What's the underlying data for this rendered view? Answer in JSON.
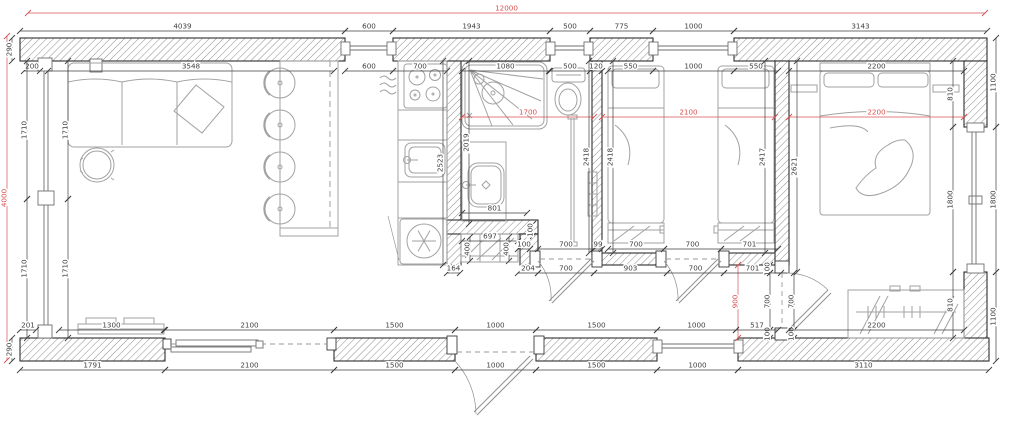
{
  "drawing": {
    "type_label": "floor-plan",
    "overall_width_mm": "12000",
    "overall_height_mm": "4000"
  },
  "colors": {
    "dim": "#3f3f3f",
    "red": "#d95050",
    "wall_stroke": "#2e2e2e",
    "hatch": "#8d8d8d",
    "furniture": "#a2a2a2"
  },
  "fixtures": [
    "sofa",
    "coffee-table",
    "bar-counter",
    "bar-stool",
    "cooktop",
    "kitchen-sink",
    "fridge",
    "shower",
    "toilet",
    "wash-basin",
    "towel-radiator",
    "hall-closet",
    "single-bed",
    "double-bed",
    "wardrobe",
    "tv-bench",
    "sliding-door",
    "entrance-door",
    "interior-door",
    "window"
  ],
  "dims": [
    {
      "x1": 28,
      "y1": 13,
      "x2": 985,
      "y2": 13,
      "t": "12000",
      "c": "red"
    },
    {
      "x1": 7,
      "y1": 36,
      "x2": 7,
      "y2": 360,
      "t": "4000",
      "c": "red"
    },
    {
      "x1": 462,
      "y1": 117,
      "x2": 594,
      "y2": 117,
      "t": "1700",
      "c": "red"
    },
    {
      "x1": 602,
      "y1": 117,
      "x2": 775,
      "y2": 117,
      "t": "2100",
      "c": "red"
    },
    {
      "x1": 789,
      "y1": 117,
      "x2": 964,
      "y2": 117,
      "t": "2200",
      "c": "red"
    },
    {
      "x1": 738,
      "y1": 265,
      "x2": 738,
      "y2": 338,
      "t": "900",
      "c": "red"
    },
    {
      "x1": 20,
      "y1": 31,
      "x2": 345,
      "y2": 31,
      "t": "4039"
    },
    {
      "x1": 345,
      "y1": 31,
      "x2": 393,
      "y2": 31,
      "t": "600"
    },
    {
      "x1": 393,
      "y1": 31,
      "x2": 550,
      "y2": 31,
      "t": "1943"
    },
    {
      "x1": 550,
      "y1": 31,
      "x2": 590,
      "y2": 31,
      "t": "500"
    },
    {
      "x1": 590,
      "y1": 31,
      "x2": 653,
      "y2": 31,
      "t": "775"
    },
    {
      "x1": 653,
      "y1": 31,
      "x2": 734,
      "y2": 31,
      "t": "1000"
    },
    {
      "x1": 734,
      "y1": 31,
      "x2": 987,
      "y2": 31,
      "t": "3143"
    },
    {
      "x1": 24,
      "y1": 71,
      "x2": 40,
      "y2": 71,
      "t": "200"
    },
    {
      "x1": 48,
      "y1": 71,
      "x2": 334,
      "y2": 71,
      "t": "3548"
    },
    {
      "x1": 345,
      "y1": 71,
      "x2": 393,
      "y2": 71,
      "t": "600"
    },
    {
      "x1": 393,
      "y1": 71,
      "x2": 447,
      "y2": 71,
      "t": "700"
    },
    {
      "x1": 462,
      "y1": 71,
      "x2": 549,
      "y2": 71,
      "t": "1080"
    },
    {
      "x1": 550,
      "y1": 71,
      "x2": 590,
      "y2": 71,
      "t": "500"
    },
    {
      "x1": 590,
      "y1": 71,
      "x2": 602,
      "y2": 71,
      "t": "120"
    },
    {
      "x1": 608,
      "y1": 71,
      "x2": 653,
      "y2": 71,
      "t": "550"
    },
    {
      "x1": 653,
      "y1": 71,
      "x2": 734,
      "y2": 71,
      "t": "1000"
    },
    {
      "x1": 734,
      "y1": 71,
      "x2": 778,
      "y2": 71,
      "t": "550"
    },
    {
      "x1": 789,
      "y1": 71,
      "x2": 964,
      "y2": 71,
      "t": "2200"
    },
    {
      "x1": 12,
      "y1": 38,
      "x2": 12,
      "y2": 61,
      "t": "290"
    },
    {
      "x1": 12,
      "y1": 338,
      "x2": 12,
      "y2": 361,
      "t": "290"
    },
    {
      "x1": 27,
      "y1": 61,
      "x2": 27,
      "y2": 199,
      "t": "1710"
    },
    {
      "x1": 27,
      "y1": 199,
      "x2": 27,
      "y2": 338,
      "t": "1710"
    },
    {
      "x1": 68,
      "y1": 61,
      "x2": 68,
      "y2": 199,
      "t": "1710"
    },
    {
      "x1": 68,
      "y1": 199,
      "x2": 68,
      "y2": 338,
      "t": "1710"
    },
    {
      "x1": 953,
      "y1": 61,
      "x2": 953,
      "y2": 127,
      "t": "810"
    },
    {
      "x1": 953,
      "y1": 127,
      "x2": 953,
      "y2": 272,
      "t": "1800"
    },
    {
      "x1": 953,
      "y1": 272,
      "x2": 953,
      "y2": 338,
      "t": "810"
    },
    {
      "x1": 996,
      "y1": 38,
      "x2": 996,
      "y2": 127,
      "t": "1100"
    },
    {
      "x1": 996,
      "y1": 127,
      "x2": 996,
      "y2": 272,
      "t": "1800"
    },
    {
      "x1": 996,
      "y1": 272,
      "x2": 996,
      "y2": 361,
      "t": "1100"
    },
    {
      "x1": 443,
      "y1": 61,
      "x2": 443,
      "y2": 265,
      "t": "2523"
    },
    {
      "x1": 469,
      "y1": 61,
      "x2": 469,
      "y2": 224,
      "t": "2019"
    },
    {
      "x1": 589,
      "y1": 61,
      "x2": 589,
      "y2": 253,
      "t": "2418"
    },
    {
      "x1": 613,
      "y1": 61,
      "x2": 613,
      "y2": 253,
      "t": "2418"
    },
    {
      "x1": 765,
      "y1": 61,
      "x2": 765,
      "y2": 253,
      "t": "2417"
    },
    {
      "x1": 797,
      "y1": 61,
      "x2": 797,
      "y2": 272,
      "t": "2621"
    },
    {
      "x1": 462,
      "y1": 213,
      "x2": 527,
      "y2": 213,
      "t": "801"
    },
    {
      "x1": 462,
      "y1": 241,
      "x2": 518,
      "y2": 241,
      "t": "697"
    },
    {
      "x1": 470,
      "y1": 237,
      "x2": 470,
      "y2": 261,
      "t": "400"
    },
    {
      "x1": 509,
      "y1": 237,
      "x2": 509,
      "y2": 261,
      "t": "400"
    },
    {
      "x1": 533,
      "y1": 224,
      "x2": 533,
      "y2": 236,
      "t": "100"
    },
    {
      "x1": 518,
      "y1": 249,
      "x2": 530,
      "y2": 249,
      "t": "100"
    },
    {
      "x1": 538,
      "y1": 249,
      "x2": 594,
      "y2": 249,
      "t": "700"
    },
    {
      "x1": 594,
      "y1": 249,
      "x2": 602,
      "y2": 249,
      "t": "99"
    },
    {
      "x1": 608,
      "y1": 249,
      "x2": 664,
      "y2": 249,
      "t": "700"
    },
    {
      "x1": 664,
      "y1": 249,
      "x2": 721,
      "y2": 249,
      "t": "700"
    },
    {
      "x1": 721,
      "y1": 249,
      "x2": 778,
      "y2": 249,
      "t": "701"
    },
    {
      "x1": 447,
      "y1": 273,
      "x2": 460,
      "y2": 273,
      "t": "164"
    },
    {
      "x1": 518,
      "y1": 273,
      "x2": 538,
      "y2": 273,
      "t": "204"
    },
    {
      "x1": 538,
      "y1": 273,
      "x2": 594,
      "y2": 273,
      "t": "700"
    },
    {
      "x1": 594,
      "y1": 273,
      "x2": 667,
      "y2": 273,
      "t": "903"
    },
    {
      "x1": 667,
      "y1": 273,
      "x2": 724,
      "y2": 273,
      "t": "700"
    },
    {
      "x1": 724,
      "y1": 273,
      "x2": 781,
      "y2": 273,
      "t": "701"
    },
    {
      "x1": 770,
      "y1": 265,
      "x2": 770,
      "y2": 273,
      "t": "100"
    },
    {
      "x1": 770,
      "y1": 273,
      "x2": 770,
      "y2": 330,
      "t": "700"
    },
    {
      "x1": 770,
      "y1": 330,
      "x2": 770,
      "y2": 338,
      "t": "100"
    },
    {
      "x1": 794,
      "y1": 273,
      "x2": 794,
      "y2": 330,
      "t": "700"
    },
    {
      "x1": 794,
      "y1": 330,
      "x2": 794,
      "y2": 338,
      "t": "100"
    },
    {
      "x1": 20,
      "y1": 330,
      "x2": 36,
      "y2": 330,
      "t": "201"
    },
    {
      "x1": 59,
      "y1": 330,
      "x2": 164,
      "y2": 330,
      "t": "1300"
    },
    {
      "x1": 165,
      "y1": 330,
      "x2": 334,
      "y2": 330,
      "t": "2100"
    },
    {
      "x1": 334,
      "y1": 330,
      "x2": 455,
      "y2": 330,
      "t": "1500"
    },
    {
      "x1": 455,
      "y1": 330,
      "x2": 536,
      "y2": 330,
      "t": "1000"
    },
    {
      "x1": 536,
      "y1": 330,
      "x2": 657,
      "y2": 330,
      "t": "1500"
    },
    {
      "x1": 657,
      "y1": 330,
      "x2": 736,
      "y2": 330,
      "t": "1000"
    },
    {
      "x1": 736,
      "y1": 330,
      "x2": 778,
      "y2": 330,
      "t": "517"
    },
    {
      "x1": 789,
      "y1": 330,
      "x2": 964,
      "y2": 330,
      "t": "2200"
    },
    {
      "x1": 20,
      "y1": 370,
      "x2": 165,
      "y2": 370,
      "t": "1791"
    },
    {
      "x1": 165,
      "y1": 370,
      "x2": 334,
      "y2": 370,
      "t": "2100"
    },
    {
      "x1": 334,
      "y1": 370,
      "x2": 455,
      "y2": 370,
      "t": "1500"
    },
    {
      "x1": 455,
      "y1": 370,
      "x2": 536,
      "y2": 370,
      "t": "1000"
    },
    {
      "x1": 536,
      "y1": 370,
      "x2": 657,
      "y2": 370,
      "t": "1500"
    },
    {
      "x1": 657,
      "y1": 370,
      "x2": 738,
      "y2": 370,
      "t": "1000"
    },
    {
      "x1": 738,
      "y1": 370,
      "x2": 989,
      "y2": 370,
      "t": "3110"
    }
  ]
}
